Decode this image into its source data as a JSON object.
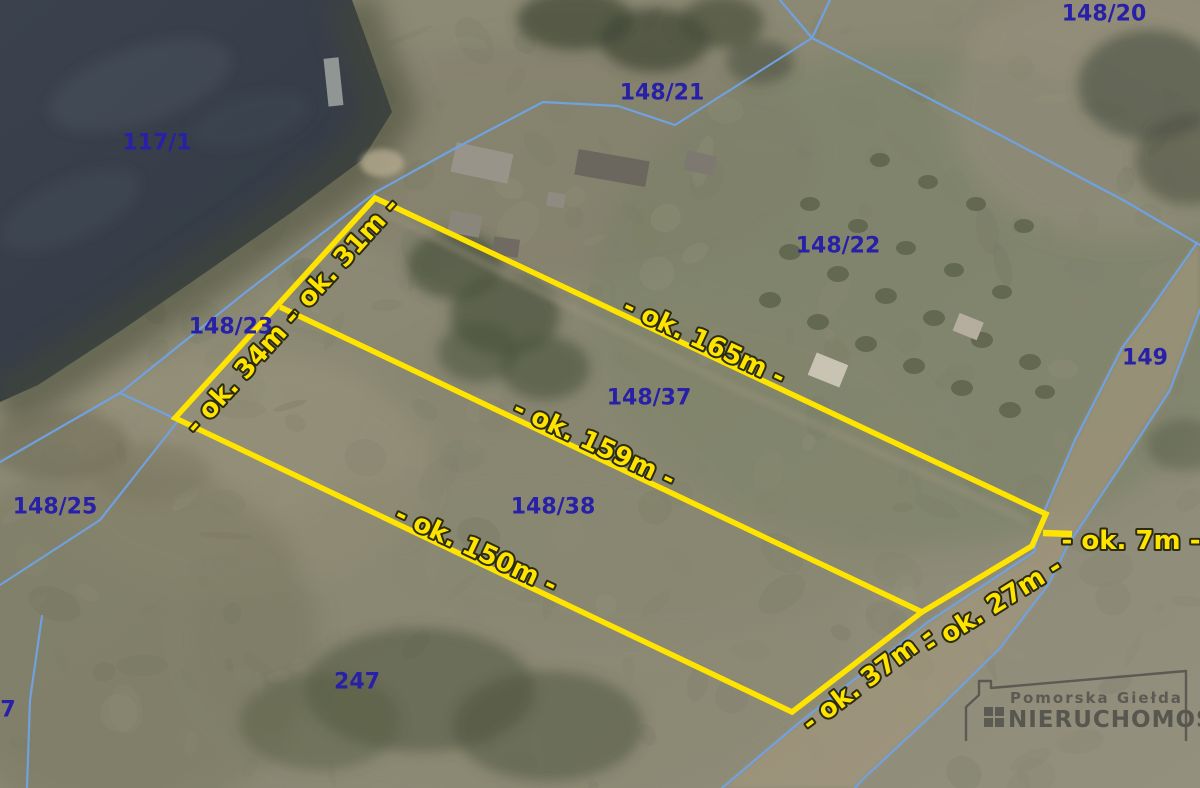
{
  "map": {
    "type": "aerial-cadastral-photo",
    "colors": {
      "boundary_blue": "#6FA3E6",
      "parcel_text_navy": "#2820A6",
      "highlight_yellow": "#FFE400",
      "water": "#3A414D"
    },
    "parcel_labels": [
      {
        "id": "117-1",
        "text": "117/1",
        "x": 157,
        "y": 143
      },
      {
        "id": "148-21",
        "text": "148/21",
        "x": 662,
        "y": 93
      },
      {
        "id": "148-20",
        "text": "148/20",
        "x": 1104,
        "y": 14
      },
      {
        "id": "148-22",
        "text": "148/22",
        "x": 838,
        "y": 246
      },
      {
        "id": "148-23",
        "text": "148/23",
        "x": 231,
        "y": 327
      },
      {
        "id": "149",
        "text": "149",
        "x": 1145,
        "y": 358
      },
      {
        "id": "148-37",
        "text": "148/37",
        "x": 649,
        "y": 398
      },
      {
        "id": "148-38",
        "text": "148/38",
        "x": 553,
        "y": 507
      },
      {
        "id": "148-25",
        "text": "148/25",
        "x": 55,
        "y": 507
      },
      {
        "id": "247",
        "text": "247",
        "x": 357,
        "y": 682
      },
      {
        "id": "7",
        "text": "7",
        "x": 8,
        "y": 710
      }
    ],
    "plot_measurements": [
      {
        "id": "31m",
        "text": "- ok. 31m -",
        "x": 342,
        "y": 260,
        "rot": -48
      },
      {
        "id": "34m",
        "text": "- ok. 34m -",
        "x": 243,
        "y": 372,
        "rot": -48
      },
      {
        "id": "165m",
        "text": "- ok. 165m -",
        "x": 704,
        "y": 342,
        "rot": 25
      },
      {
        "id": "159m",
        "text": "- ok. 159m -",
        "x": 594,
        "y": 444,
        "rot": 25
      },
      {
        "id": "150m",
        "text": "- ok. 150m -",
        "x": 476,
        "y": 550,
        "rot": 25
      },
      {
        "id": "7m",
        "text": "- ok. 7m -",
        "x": 1131,
        "y": 541,
        "rot": 0
      },
      {
        "id": "27m",
        "text": "- ok. 27m -",
        "x": 993,
        "y": 606,
        "rot": -32
      },
      {
        "id": "37m",
        "text": "- ok. 37m -",
        "x": 868,
        "y": 679,
        "rot": -37
      }
    ],
    "watermark": {
      "line1": "Pomorska Giełda",
      "line2": "NIERUCHOMOŚCI"
    }
  }
}
